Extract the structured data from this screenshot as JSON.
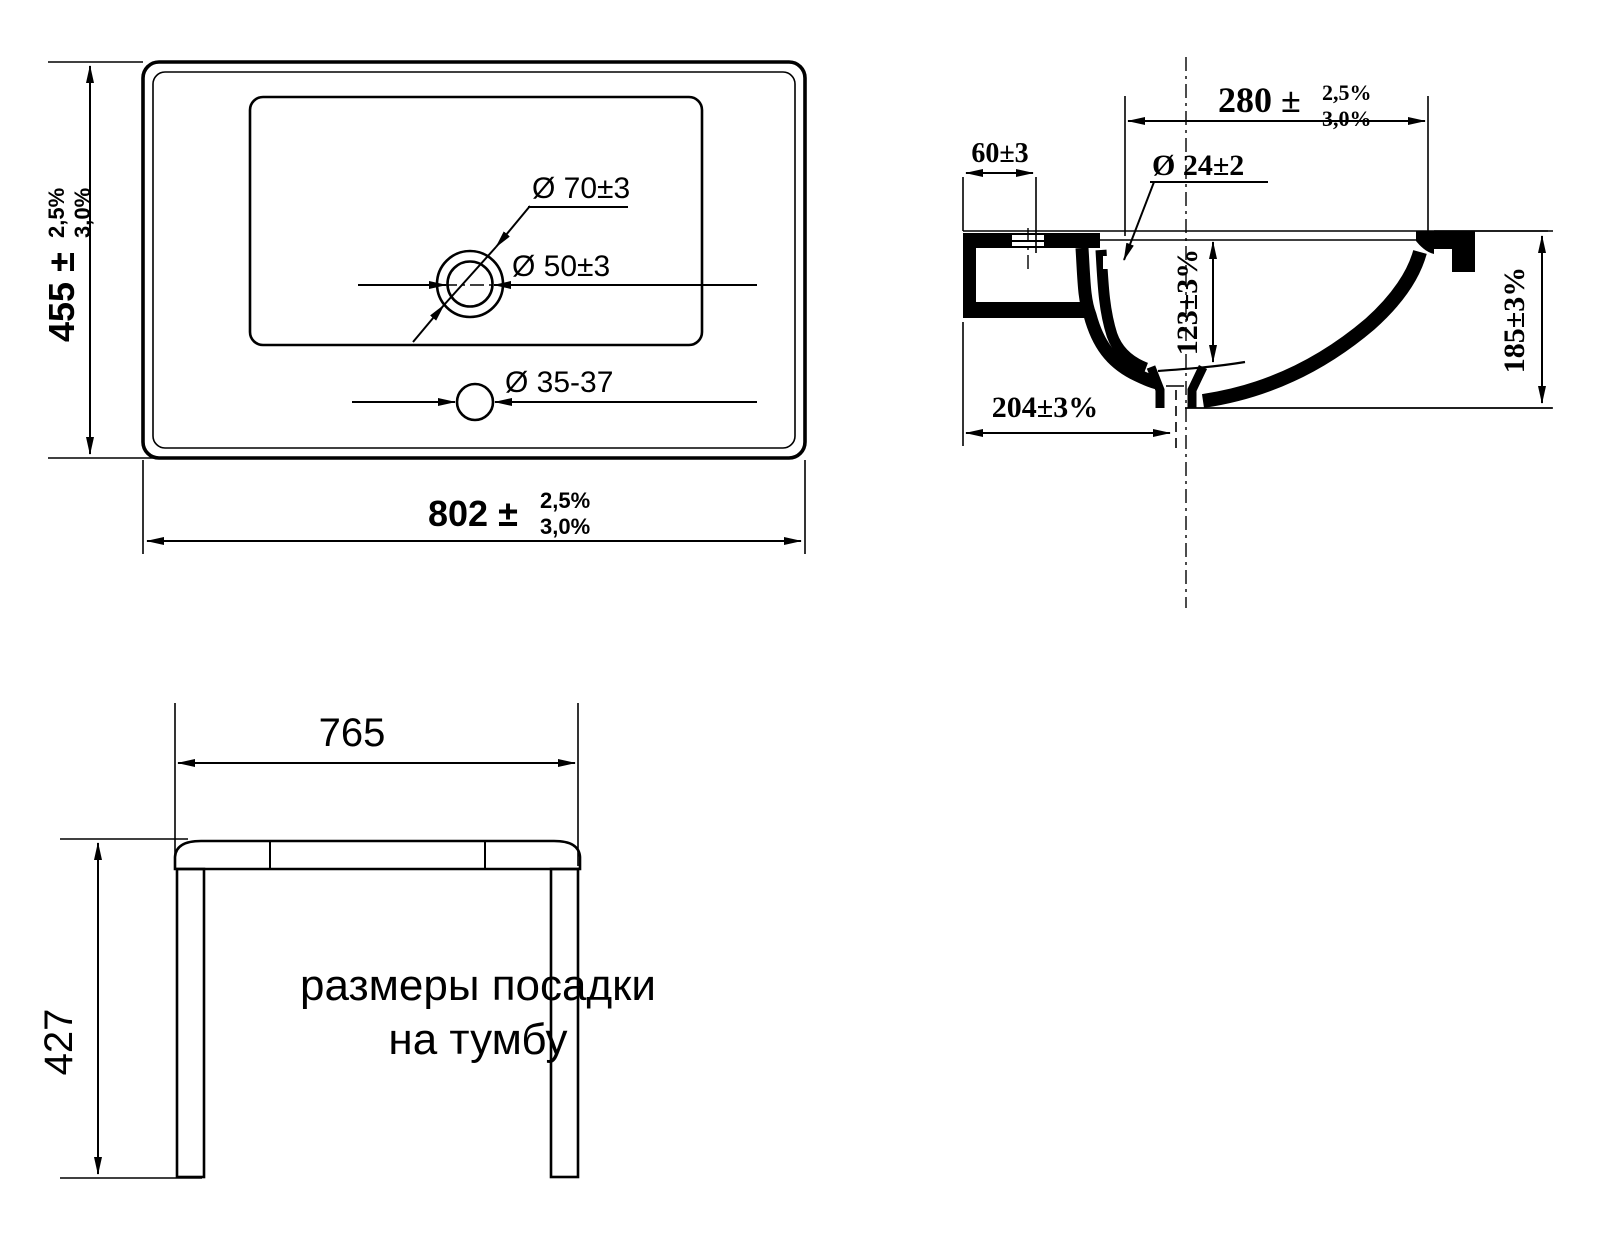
{
  "meta": {
    "background": "#ffffff",
    "line_color": "#000000",
    "drawing_type": "washbasin dimensional drawing"
  },
  "top_view": {
    "height_dim": {
      "main": "455 ±",
      "sup": "2,5%",
      "sub": "3,0%"
    },
    "width_dim": {
      "main": "802 ±",
      "sup": "2,5%",
      "sub": "3,0%"
    },
    "drain_outer_label": "Ø 70±3",
    "drain_inner_label": "Ø 50±3",
    "faucet_label": "Ø 35-37"
  },
  "side_view": {
    "depth_dim": {
      "main": "280 ±",
      "sup": "2,5%",
      "sub": "3,0%"
    },
    "ledge_label": "60±3",
    "overflow_label": "Ø 24±2",
    "bowl_depth_label": "123±3%",
    "height_label": "185±3%",
    "drain_offset_label": "204±3%"
  },
  "mount_view": {
    "width_label": "765",
    "height_label": "427",
    "caption_line1": "размеры посадки",
    "caption_line2": "на тумбу"
  }
}
